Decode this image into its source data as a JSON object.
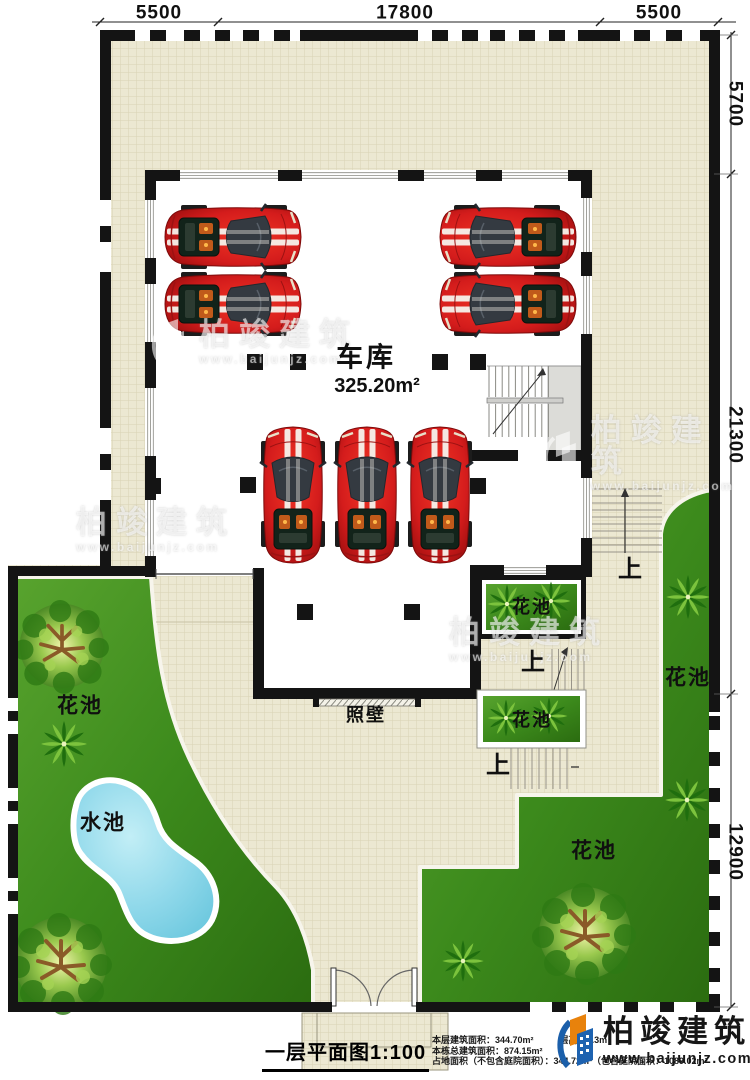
{
  "dimensions": {
    "top": [
      "5500",
      "17800",
      "5500"
    ],
    "right": [
      "5700",
      "21300",
      "12900"
    ]
  },
  "rooms": {
    "garage_label": "车库",
    "garage_area": "325.20m²"
  },
  "site": {
    "flower_bed": "花池",
    "water_pool": "水池",
    "screen_wall": "照壁",
    "stairs_up": "上"
  },
  "title_block": {
    "title": "一层平面图1:100",
    "floor_area_label": "本层建筑面积：",
    "floor_area_value": "344.70m²",
    "floor_height_label": "层高：",
    "floor_height_value": "3.3m",
    "total_area_label": "本栋总建筑面积：",
    "total_area_value": "874.15m²",
    "footprint_line": "占地面积（不包含庭院面积）：344.72m²（包含庭院面积：1089.02m²"
  },
  "brand": {
    "name": "柏竣建筑",
    "url": "www.baijunjz.com"
  },
  "watermark": {
    "name": "柏竣建筑",
    "url": "www.baijunjz.com"
  },
  "colors": {
    "wall": "#141414",
    "tile": "#ece8d2",
    "grass": "#3f8a1f",
    "pool": "#7fd2e6",
    "car_red": "#d41c1c",
    "brand_blue": "#1b5faa",
    "brand_orange": "#e8820c"
  }
}
